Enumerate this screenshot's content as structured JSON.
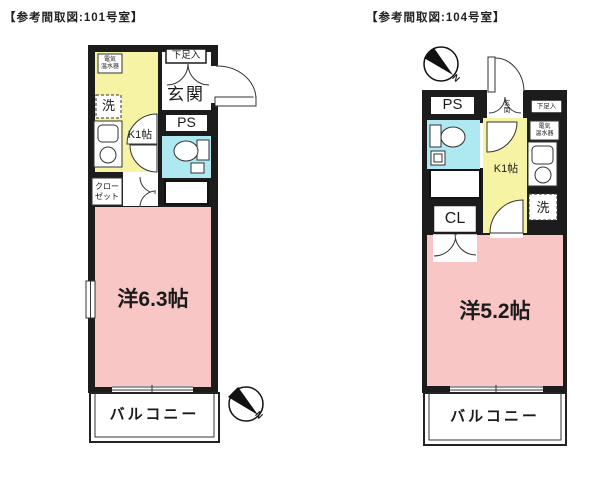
{
  "colors": {
    "wall": "#1c1c1c",
    "room_pink": "#f7c6c5",
    "kitchen_yellow": "#f6f3a4",
    "bath_cyan": "#aee8f0",
    "line": "#333333"
  },
  "plan_101": {
    "title": "【参考間取図:101号室】",
    "labels": {
      "water_heater": "電気\n温水器",
      "washer": "洗",
      "shoe_box": "下足入",
      "entrance": "玄関",
      "pipe_space": "PS",
      "kitchen": "K1帖",
      "closet": "クロー\nゼット",
      "room": "洋6.3帖",
      "balcony": "バルコニー",
      "compass_north": "N"
    }
  },
  "plan_104": {
    "title": "【参考間取図:104号室】",
    "labels": {
      "pipe_space": "PS",
      "entrance": "玄\n関",
      "shoe_box": "下足入",
      "water_heater": "電気\n温水器",
      "kitchen": "K1帖",
      "washer": "洗",
      "closet": "CL",
      "room": "洋5.2帖",
      "balcony": "バルコニー",
      "compass_north": "N"
    }
  }
}
